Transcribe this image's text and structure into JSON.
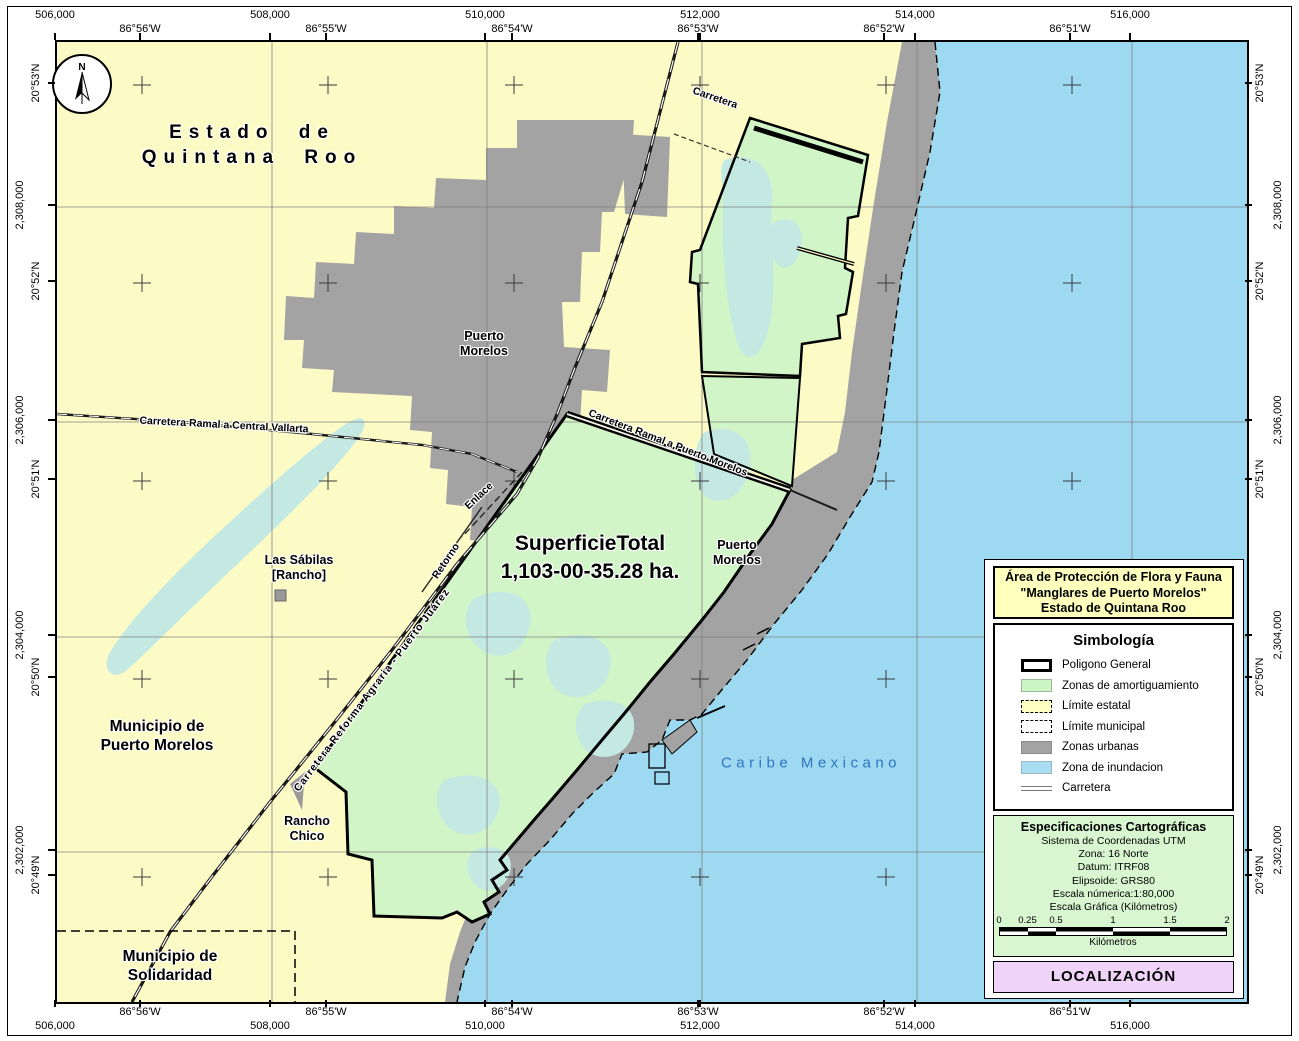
{
  "compass": {
    "north": "N"
  },
  "frame": {
    "utm_eastings": [
      "506,000",
      "508,000",
      "510,000",
      "512,000",
      "514,000",
      "516,000"
    ],
    "longitudes": [
      "86°56'W",
      "86°55'W",
      "86°54'W",
      "86°53'W",
      "86°52'W",
      "86°51'W"
    ],
    "utm_northings": [
      "2,308,000",
      "2,306,000",
      "2,304,000",
      "2,302,000"
    ],
    "latitudes": [
      "20°53'N",
      "20°52'N",
      "20°51'N",
      "20°50'N",
      "20°49'N"
    ]
  },
  "labels": {
    "estado": {
      "line1": "Estado de",
      "line2": "Quintana Roo"
    },
    "municipio_puerto_morelos": {
      "line1": "Municipio de",
      "line2": "Puerto Morelos"
    },
    "municipio_solidaridad": {
      "line1": "Municipio de",
      "line2": "Solidaridad"
    },
    "superficie": {
      "line1": "SuperficieTotal",
      "line2": "1,103-00-35.28 ha."
    },
    "puerto_morelos_town": {
      "line1": "Puerto",
      "line2": "Morelos"
    },
    "puerto_morelos_port": {
      "line1": "Puerto",
      "line2": "Morelos"
    },
    "las_sabilas": {
      "line1": "Las Sábilas",
      "line2": "[Rancho]"
    },
    "rancho_chico": {
      "line1": "Rancho",
      "line2": "Chico"
    },
    "caribe": "Caribe Mexicano",
    "roads": {
      "carretera_top": "Carretera",
      "ramal_central_vallarta": "Carretera Ramal a Central Vallarta",
      "ramal_puerto_morelos": "Carretera Ramal a Puerto Morelos",
      "enlace": "Enlace",
      "retorno": "Retorno",
      "reforma_agraria": "Carretera Reforma Agraria - Puerto Juárez"
    }
  },
  "panel": {
    "title": {
      "line1": "Área de Protección de Flora y Fauna",
      "line2": "\"Manglares de Puerto Morelos\"",
      "line3": "Estado de Quintana Roo"
    },
    "legend": {
      "title": "Simbología",
      "items": [
        {
          "swatch": "poligono",
          "label": "Poligono General"
        },
        {
          "swatch": "amortiguamiento",
          "label": "Zonas de amortiguamiento"
        },
        {
          "swatch": "estatal",
          "label": "Límite estatal"
        },
        {
          "swatch": "municipal",
          "label": "Límite municipal"
        },
        {
          "swatch": "urbanas",
          "label": "Zonas urbanas"
        },
        {
          "swatch": "inundacion",
          "label": "Zona de inundacion"
        },
        {
          "swatch": "carretera",
          "label": "Carretera"
        }
      ]
    },
    "specs": {
      "title": "Especificaciones Cartográficas",
      "lines": [
        "Sistema de Coordenadas UTM",
        "Zona: 16 Norte",
        "Datum: ITRF08",
        "Elipsoide: GRS80",
        "Escala númerica:1:80,000",
        "Escala Gráfica (Kilómetros)"
      ],
      "scalebar": {
        "ticks": [
          "0",
          "0.25",
          "0.5",
          "1",
          "1.5",
          "2"
        ],
        "unit": "Kilómetros"
      }
    },
    "localizacion": "LOCALIZACIÓN"
  },
  "colors": {
    "sea": "#9ED9F2",
    "land": "#FCFBC5",
    "buffer_zone": "#D2F5C8",
    "flood_zone": "#C4E9E2",
    "urban": "#A3A3A3",
    "title_bg": "#FFFFBE",
    "specs_bg": "#D8F7D0",
    "localizacion_bg": "#F0D3F8",
    "caribe_text": "#2F74C0"
  }
}
